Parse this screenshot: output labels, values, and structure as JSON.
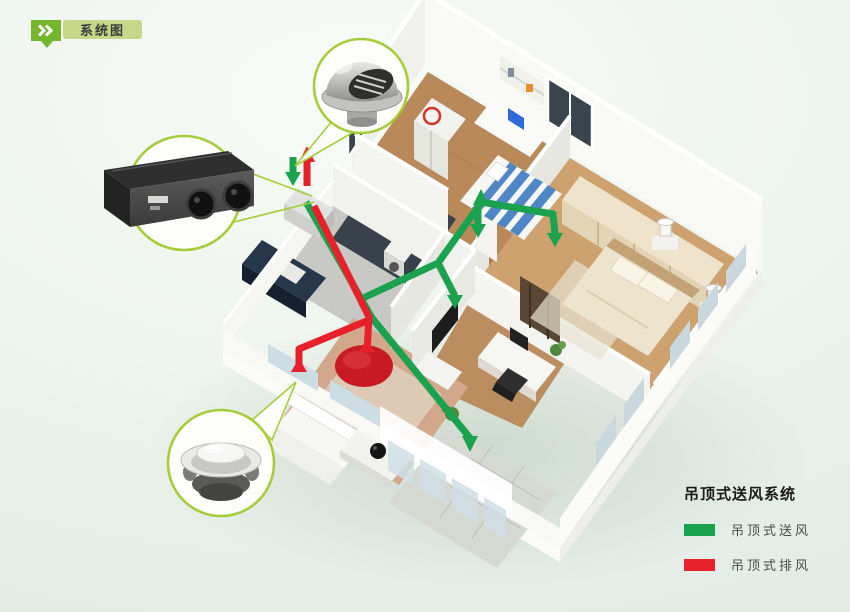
{
  "badge": {
    "label": "系统图"
  },
  "legend": {
    "title": "吊顶式送风系统",
    "items": [
      {
        "id": "supply",
        "label": "吊顶式送风",
        "color": "#1aa24e"
      },
      {
        "id": "exhaust",
        "label": "吊顶式排风",
        "color": "#e62129"
      }
    ]
  },
  "callouts": [
    {
      "name": "outdoor-vent-cap",
      "depicts": "round exterior wall vent cap with louvers"
    },
    {
      "name": "ceiling-ventilation-unit",
      "depicts": "ceiling-mounted heat-recovery ventilator with two duct ports"
    },
    {
      "name": "ceiling-diffuser",
      "depicts": "round white ceiling supply/exhaust diffuser"
    }
  ],
  "diagram": {
    "type": "isometric-apartment-cutaway",
    "rooms": [
      "kids-bedroom",
      "master-bedroom",
      "study",
      "living-room",
      "kitchen",
      "bathroom",
      "corridor",
      "balcony"
    ],
    "duct_networks": [
      {
        "id": "supply",
        "color": "#1aa24e",
        "route": "from ceiling unit through corridor into bedrooms, study and living room, arrows blowing down"
      },
      {
        "id": "exhaust",
        "color": "#e62129",
        "route": "from living room pickups back to ceiling unit and out through wall vent, arrows drawing up"
      }
    ]
  },
  "colors": {
    "supply_duct": "#1aa24e",
    "exhaust_duct": "#e62129",
    "callout_border": "#a5cd39",
    "badge_green": "#74b62c",
    "badge_light_green": "#c6d788",
    "background_top": "#f8fbf7",
    "background_bottom": "#e2ebe5"
  }
}
